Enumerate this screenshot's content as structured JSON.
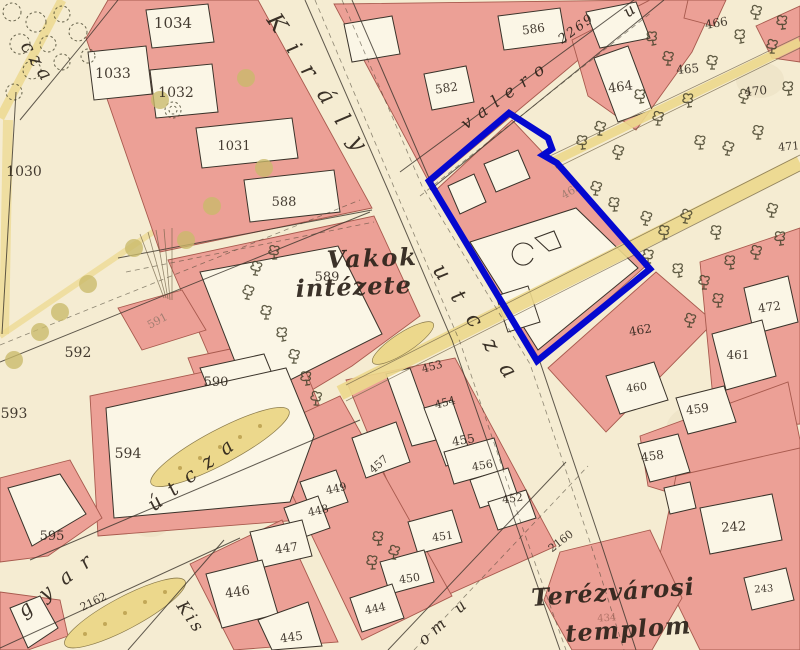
{
  "colors": {
    "paper": "#f5ecd2",
    "block": "#eca096",
    "block_edge": "#a85a4e",
    "plot": "#fbf6e6",
    "plot_edge": "#3a332a",
    "road": "#ecd88c",
    "road_edge": "#8a7a4a",
    "ink": "#2b2219",
    "faint": "#8a7265",
    "faint_red": "#a4685c",
    "tree": "#44412a",
    "park_tree": "#c9ba6a",
    "highlight": "#0508cf"
  },
  "street_labels": [
    {
      "n": "cza",
      "t": "cza",
      "x": 20,
      "y": 46,
      "r": 58,
      "s": 19,
      "sp": 5,
      "b": false
    },
    {
      "n": "kiraly",
      "t": "Király",
      "x": 266,
      "y": 20,
      "r": 56,
      "s": 23,
      "sp": 18,
      "b": false
    },
    {
      "n": "kiraly-utcza",
      "t": "utcza",
      "x": 432,
      "y": 270,
      "r": 56,
      "s": 22,
      "sp": 18,
      "b": false
    },
    {
      "n": "valero",
      "t": "valero",
      "x": 466,
      "y": 130,
      "r": -36,
      "s": 17,
      "sp": 9,
      "b": false
    },
    {
      "n": "valero-number",
      "t": "2269",
      "x": 562,
      "y": 44,
      "r": -36,
      "s": 13,
      "sp": 2,
      "b": false
    },
    {
      "n": "valero-u",
      "t": "u",
      "x": 628,
      "y": 18,
      "r": -36,
      "s": 16,
      "sp": 0,
      "b": false
    },
    {
      "n": "vakok-line1",
      "t": "Vakok",
      "x": 327,
      "y": 268,
      "r": -2,
      "s": 24,
      "sp": 2,
      "b": true
    },
    {
      "n": "vakok-line2",
      "t": "intézete",
      "x": 296,
      "y": 297,
      "r": -2,
      "s": 24,
      "sp": 1,
      "b": true
    },
    {
      "n": "gyar",
      "t": "gyar",
      "x": 24,
      "y": 618,
      "r": -38,
      "s": 20,
      "sp": 14,
      "b": false
    },
    {
      "n": "gyar-utcza",
      "t": "útcza",
      "x": 154,
      "y": 512,
      "r": -38,
      "s": 20,
      "sp": 12,
      "b": false
    },
    {
      "n": "kis",
      "t": "Kis",
      "x": 176,
      "y": 606,
      "r": 55,
      "s": 17,
      "sp": 3,
      "b": false
    },
    {
      "n": "om-u",
      "t": "om u",
      "x": 424,
      "y": 646,
      "r": -42,
      "s": 16,
      "sp": 6,
      "b": false
    },
    {
      "n": "terezvarosi",
      "t": "Terézvárosi",
      "x": 532,
      "y": 606,
      "r": -4,
      "s": 24,
      "sp": 1,
      "b": true
    },
    {
      "n": "templom",
      "t": "templom",
      "x": 566,
      "y": 642,
      "r": -4,
      "s": 24,
      "sp": 1,
      "b": true
    }
  ],
  "plot_numbers": [
    {
      "t": "1034",
      "x": 173,
      "y": 28,
      "r": 0,
      "s": 15
    },
    {
      "t": "1033",
      "x": 113,
      "y": 78,
      "r": 0,
      "s": 14
    },
    {
      "t": "1032",
      "x": 176,
      "y": 97,
      "r": 0,
      "s": 14
    },
    {
      "t": "1031",
      "x": 234,
      "y": 150,
      "r": 0,
      "s": 13
    },
    {
      "t": "1030",
      "x": 24,
      "y": 176,
      "r": 0,
      "s": 14
    },
    {
      "t": "586",
      "x": 534,
      "y": 33,
      "r": -8,
      "s": 12
    },
    {
      "t": "582",
      "x": 447,
      "y": 92,
      "r": -8,
      "s": 12
    },
    {
      "t": "466",
      "x": 717,
      "y": 27,
      "r": -10,
      "s": 12
    },
    {
      "t": "465",
      "x": 688,
      "y": 73,
      "r": -5,
      "s": 12
    },
    {
      "t": "464",
      "x": 621,
      "y": 91,
      "r": -8,
      "s": 13
    },
    {
      "t": "470",
      "x": 756,
      "y": 95,
      "r": -5,
      "s": 12
    },
    {
      "t": "471",
      "x": 789,
      "y": 150,
      "r": -5,
      "s": 11
    },
    {
      "t": "588",
      "x": 284,
      "y": 206,
      "r": 0,
      "s": 13
    },
    {
      "t": "589",
      "x": 327,
      "y": 281,
      "r": 0,
      "s": 13
    },
    {
      "t": "592",
      "x": 78,
      "y": 357,
      "r": 0,
      "s": 14
    },
    {
      "t": "591",
      "x": 159,
      "y": 324,
      "r": -28,
      "s": 11,
      "c": "faint"
    },
    {
      "t": "590",
      "x": 216,
      "y": 386,
      "r": 0,
      "s": 13
    },
    {
      "t": "593",
      "x": 14,
      "y": 418,
      "r": 0,
      "s": 14
    },
    {
      "t": "594",
      "x": 128,
      "y": 458,
      "r": 0,
      "s": 14
    },
    {
      "t": "595",
      "x": 52,
      "y": 540,
      "r": 0,
      "s": 13
    },
    {
      "t": "2162",
      "x": 95,
      "y": 605,
      "r": -26,
      "s": 11
    },
    {
      "t": "463",
      "x": 573,
      "y": 194,
      "r": -30,
      "s": 11,
      "c": "faint"
    },
    {
      "t": "462",
      "x": 641,
      "y": 334,
      "r": -10,
      "s": 12
    },
    {
      "t": "472",
      "x": 770,
      "y": 311,
      "r": -8,
      "s": 12
    },
    {
      "t": "461",
      "x": 738,
      "y": 359,
      "r": 0,
      "s": 12
    },
    {
      "t": "460",
      "x": 637,
      "y": 391,
      "r": -8,
      "s": 11
    },
    {
      "t": "459",
      "x": 698,
      "y": 413,
      "r": -8,
      "s": 12
    },
    {
      "t": "458",
      "x": 653,
      "y": 460,
      "r": -8,
      "s": 12
    },
    {
      "t": "453",
      "x": 433,
      "y": 370,
      "r": -15,
      "s": 11
    },
    {
      "t": "454",
      "x": 446,
      "y": 406,
      "r": -15,
      "s": 11
    },
    {
      "t": "455",
      "x": 464,
      "y": 444,
      "r": -10,
      "s": 12
    },
    {
      "t": "456",
      "x": 483,
      "y": 469,
      "r": -10,
      "s": 11
    },
    {
      "t": "452",
      "x": 513,
      "y": 502,
      "r": -8,
      "s": 11
    },
    {
      "t": "457",
      "x": 381,
      "y": 467,
      "r": -42,
      "s": 11
    },
    {
      "t": "451",
      "x": 443,
      "y": 540,
      "r": -8,
      "s": 11
    },
    {
      "t": "450",
      "x": 410,
      "y": 582,
      "r": -8,
      "s": 11
    },
    {
      "t": "449",
      "x": 337,
      "y": 492,
      "r": -12,
      "s": 11
    },
    {
      "t": "448",
      "x": 319,
      "y": 514,
      "r": -12,
      "s": 11
    },
    {
      "t": "447",
      "x": 287,
      "y": 552,
      "r": -8,
      "s": 12
    },
    {
      "t": "446",
      "x": 238,
      "y": 596,
      "r": -8,
      "s": 13
    },
    {
      "t": "445",
      "x": 292,
      "y": 641,
      "r": -8,
      "s": 12
    },
    {
      "t": "444",
      "x": 376,
      "y": 612,
      "r": -12,
      "s": 11
    },
    {
      "t": "242",
      "x": 734,
      "y": 531,
      "r": -4,
      "s": 13
    },
    {
      "t": "243",
      "x": 764,
      "y": 592,
      "r": -4,
      "s": 10
    },
    {
      "t": "2160",
      "x": 563,
      "y": 544,
      "r": -38,
      "s": 11
    },
    {
      "t": "434",
      "x": 607,
      "y": 621,
      "r": -4,
      "s": 10,
      "c": "faintred"
    }
  ],
  "highlight": {
    "color": "#0508cf",
    "stroke_width": 6.5,
    "points": [
      [
        429,
        181
      ],
      [
        509,
        113
      ],
      [
        548,
        138
      ],
      [
        552,
        149
      ],
      [
        543,
        155
      ],
      [
        557,
        163
      ],
      [
        650,
        269
      ],
      [
        537,
        361
      ]
    ]
  },
  "trees": {
    "dark": [
      [
        652,
        38
      ],
      [
        668,
        58
      ],
      [
        640,
        96
      ],
      [
        658,
        118
      ],
      [
        688,
        100
      ],
      [
        600,
        128
      ],
      [
        582,
        142
      ],
      [
        618,
        152
      ],
      [
        700,
        142
      ],
      [
        728,
        148
      ],
      [
        758,
        132
      ],
      [
        744,
        96
      ],
      [
        712,
        62
      ],
      [
        740,
        36
      ],
      [
        772,
        46
      ],
      [
        788,
        88
      ],
      [
        756,
        12
      ],
      [
        782,
        22
      ],
      [
        596,
        188
      ],
      [
        614,
        204
      ],
      [
        646,
        218
      ],
      [
        664,
        232
      ],
      [
        686,
        216
      ],
      [
        648,
        256
      ],
      [
        678,
        270
      ],
      [
        704,
        282
      ],
      [
        730,
        262
      ],
      [
        756,
        252
      ],
      [
        780,
        238
      ],
      [
        772,
        210
      ],
      [
        716,
        232
      ],
      [
        690,
        320
      ],
      [
        718,
        300
      ],
      [
        256,
        268
      ],
      [
        274,
        252
      ],
      [
        248,
        292
      ],
      [
        266,
        312
      ],
      [
        282,
        334
      ],
      [
        294,
        356
      ],
      [
        306,
        378
      ],
      [
        316,
        398
      ],
      [
        378,
        538
      ],
      [
        394,
        552
      ],
      [
        372,
        562
      ]
    ],
    "park": [
      [
        160,
        100
      ],
      [
        246,
        78
      ],
      [
        212,
        206
      ],
      [
        186,
        240
      ],
      [
        264,
        168
      ],
      [
        134,
        248
      ],
      [
        88,
        284
      ],
      [
        60,
        312
      ],
      [
        14,
        360
      ],
      [
        40,
        332
      ]
    ],
    "bushes": [
      [
        12,
        12,
        9
      ],
      [
        36,
        22,
        10
      ],
      [
        62,
        14,
        8
      ],
      [
        20,
        44,
        10
      ],
      [
        48,
        44,
        8
      ],
      [
        78,
        32,
        9
      ],
      [
        32,
        70,
        9
      ],
      [
        62,
        62,
        8
      ],
      [
        14,
        92,
        8
      ],
      [
        88,
        56,
        7
      ]
    ]
  },
  "oval_dots": [
    [
      85,
      634
    ],
    [
      105,
      624
    ],
    [
      125,
      613
    ],
    [
      145,
      602
    ],
    [
      165,
      592
    ],
    [
      180,
      468
    ],
    [
      200,
      458
    ],
    [
      220,
      447
    ],
    [
      240,
      437
    ],
    [
      260,
      426
    ]
  ]
}
